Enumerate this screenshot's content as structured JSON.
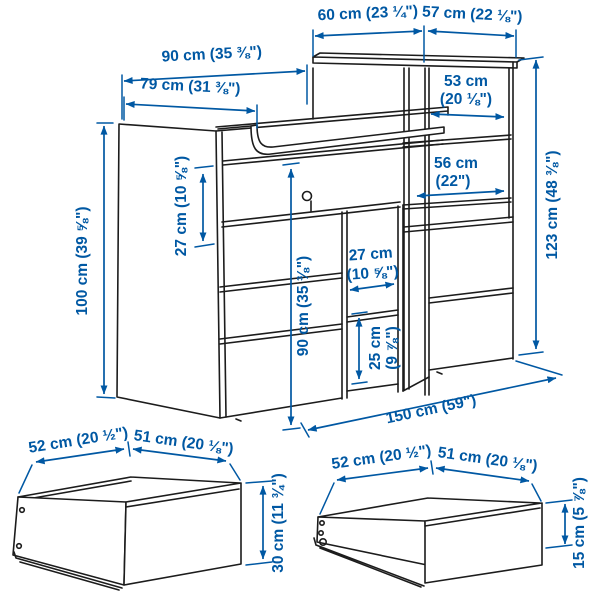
{
  "diagram_title": "furniture-dimension-diagram",
  "colors": {
    "background": "#ffffff",
    "line_art": "#1c1c1c",
    "dimension_blue": "#0058a3"
  },
  "main_unit": {
    "dim_top_depth": "60 cm (23 ¼\")",
    "dim_top_width": "57 cm (22 ⅛\")",
    "dim_chest_top_width": "90 cm (35 ⅜\")",
    "dim_table_top_width": "79 cm (31 ⅜\")",
    "dim_upper_shelf_line1": "53 cm",
    "dim_upper_shelf_line2": "(20 ⅛\")",
    "dim_lower_shelf_line1": "56 cm",
    "dim_lower_shelf_line2": "(22\")",
    "dim_total_height": "123 cm (48 ⅜\")",
    "dim_top_compartment_height": "27 cm (10 ⅝\")",
    "dim_chest_height": "100 cm (39 ⅝\")",
    "dim_front_height": "90 cm (35 ⅜\")",
    "dim_niche_width_line1": "27 cm",
    "dim_niche_width_line2": "(10 ⅝\")",
    "dim_niche_height_line1": "25 cm",
    "dim_niche_height_line2": "(9 ⅞\")",
    "dim_total_width": "150 cm (59\")"
  },
  "large_drawer": {
    "dim_depth": "52 cm (20 ½\")",
    "dim_width": "51 cm (20 ⅛\")",
    "dim_height": "30 cm (11 ¾\")"
  },
  "small_drawer": {
    "dim_depth": "52 cm (20 ½\")",
    "dim_width": "51 cm (20 ⅛\")",
    "dim_height": "15 cm (5 ⅞\")"
  }
}
